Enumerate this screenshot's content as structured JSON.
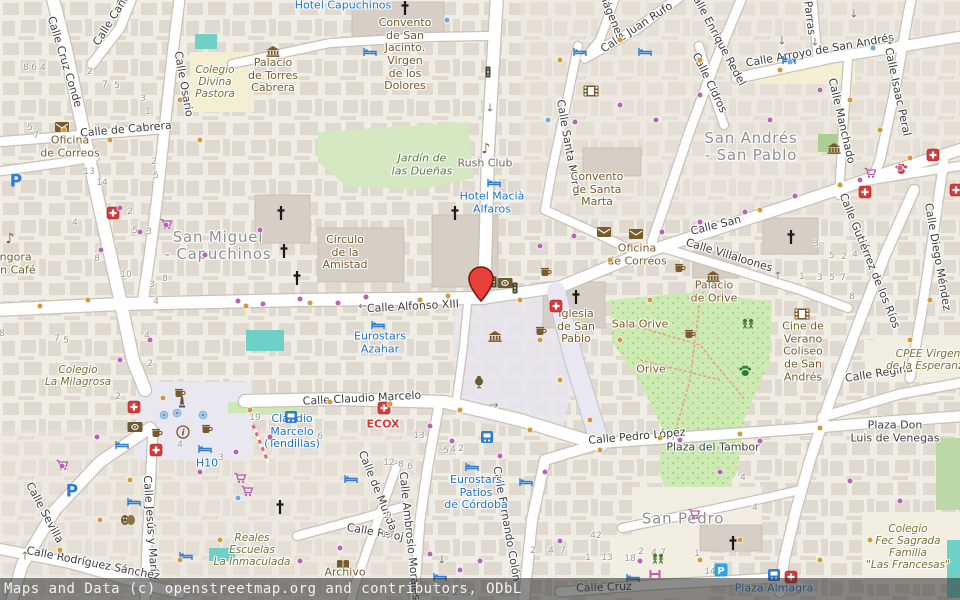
{
  "map": {
    "attribution": "Maps and Data (c) openstreetmap.org and contributors, ODbL",
    "marker": {
      "x": 481,
      "y": 301,
      "fill": "#e8413a",
      "outline": "#7d150f"
    },
    "colors": {
      "land": "#f0ede4",
      "building": "#dcd4cb",
      "road": "#ffffff",
      "casing": "#c8c2b8",
      "pedestrian": "#e9e8f2",
      "park": "#cdeab2",
      "pool": "#6fd0c8",
      "school": "#f4efd2",
      "hotel_blue": "#1f72c9",
      "poi_brown": "#7a5a2b",
      "pharmacy_red": "#d63a3a"
    },
    "district_labels": [
      {
        "t": "San Miguel\n- Capuchinos",
        "x": 218,
        "y": 246
      },
      {
        "t": "San Andrés\n- San Pablo",
        "x": 751,
        "y": 147
      },
      {
        "t": "San Pedro",
        "x": 683,
        "y": 519
      }
    ],
    "street_labels": [
      {
        "t": "Calle Cruz Conde",
        "x": 64,
        "y": 62,
        "r": 73
      },
      {
        "t": "Calle Osario",
        "x": 183,
        "y": 84,
        "r": 80
      },
      {
        "t": "Calle Caño",
        "x": 112,
        "y": 20,
        "r": -58
      },
      {
        "t": "Calle de Cabrera",
        "x": 126,
        "y": 130,
        "r": -5
      },
      {
        "t": "Calle Alfonso XIII",
        "x": 413,
        "y": 307,
        "r": -3
      },
      {
        "t": "Calle San",
        "x": 716,
        "y": 226,
        "r": -14
      },
      {
        "t": "Calle Villaloones",
        "x": 729,
        "y": 256,
        "r": 17
      },
      {
        "t": "Calle Santa Marta",
        "x": 568,
        "y": 148,
        "r": 80
      },
      {
        "t": "Calle Juan Rufo",
        "x": 637,
        "y": 28,
        "r": -33
      },
      {
        "t": "Imágenes",
        "x": 610,
        "y": 14,
        "r": 68
      },
      {
        "t": "Calle Enrique Redel",
        "x": 717,
        "y": 38,
        "r": 62
      },
      {
        "t": "Parras",
        "x": 809,
        "y": 18,
        "r": 83
      },
      {
        "t": "Calle Arroyo de San Andrés",
        "x": 820,
        "y": 51,
        "r": -10
      },
      {
        "t": "Calle Cidros",
        "x": 709,
        "y": 83,
        "r": 64
      },
      {
        "t": "Calle Manchado",
        "x": 841,
        "y": 121,
        "r": 77
      },
      {
        "t": "Calle Isaac Peral",
        "x": 897,
        "y": 92,
        "r": 78
      },
      {
        "t": "Calle Diego Méndez",
        "x": 937,
        "y": 257,
        "r": 80
      },
      {
        "t": "Calle Gutiérrez de los Ríos",
        "x": 869,
        "y": 261,
        "r": 68
      },
      {
        "t": "Calle Regina",
        "x": 879,
        "y": 374,
        "r": -9
      },
      {
        "t": "Calle Claudio Marcelo",
        "x": 362,
        "y": 399,
        "r": -3
      },
      {
        "t": "Calle Pedro López",
        "x": 637,
        "y": 437,
        "r": -5
      },
      {
        "t": "Calle Fernando Colón",
        "x": 506,
        "y": 524,
        "r": 80
      },
      {
        "t": "Calle Ambrosio Morales",
        "x": 409,
        "y": 536,
        "r": 84
      },
      {
        "t": "Calle de Munda",
        "x": 377,
        "y": 491,
        "r": 68
      },
      {
        "t": "Calle Reloj",
        "x": 375,
        "y": 533,
        "r": 10
      },
      {
        "t": "Calle Jesús y María",
        "x": 150,
        "y": 527,
        "r": 86
      },
      {
        "t": "Calle Sevilla",
        "x": 44,
        "y": 513,
        "r": 62
      },
      {
        "t": "Calle Rodríguez Sánchez",
        "x": 93,
        "y": 564,
        "r": 11
      },
      {
        "t": "Calle Cruz",
        "x": 604,
        "y": 588,
        "r": -2
      },
      {
        "t": "Plaza del Tambor",
        "x": 713,
        "y": 448,
        "r": 0,
        "w": 95
      },
      {
        "t": "Plaza Don\nLuis de Venegas",
        "x": 895,
        "y": 432,
        "r": 0
      }
    ],
    "place_labels": [
      {
        "t": "Oficina\nde Correos",
        "x": 70,
        "y": 147,
        "c": "poi"
      },
      {
        "t": "Oficina\nde Correos",
        "x": 637,
        "y": 255,
        "c": "poi"
      },
      {
        "t": "Colegio\nDivina\nPastora",
        "x": 215,
        "y": 82,
        "c": "school"
      },
      {
        "t": "Palacio\nde Torres\nCabrera",
        "x": 273,
        "y": 76,
        "c": "poi"
      },
      {
        "t": "Hotel Capuchinos",
        "x": 343,
        "y": 6,
        "c": "hotel"
      },
      {
        "t": "Convento\nde San\nJacinto.\nVirgen\nde los\nDolores",
        "x": 405,
        "y": 55,
        "c": "poi"
      },
      {
        "t": "Jardín de\nlas Dueñas",
        "x": 422,
        "y": 165,
        "c": "park"
      },
      {
        "t": "Rush Club",
        "x": 485,
        "y": 164,
        "c": "club"
      },
      {
        "t": "Hotel Macià\nAlfaros",
        "x": 492,
        "y": 203,
        "c": "hotel"
      },
      {
        "t": "Convento\nde Santa\nMarta",
        "x": 597,
        "y": 190,
        "c": "poi"
      },
      {
        "t": "Círculo\nde la\nAmistad",
        "x": 345,
        "y": 253,
        "c": "poi"
      },
      {
        "t": "Eurostars\nAzahar",
        "x": 380,
        "y": 343,
        "c": "hotel"
      },
      {
        "t": "Iglesia\nde San\nPablo",
        "x": 576,
        "y": 327,
        "c": "poi"
      },
      {
        "t": "Sala Orive",
        "x": 640,
        "y": 325,
        "c": "poi"
      },
      {
        "t": "Orive",
        "x": 651,
        "y": 370,
        "c": "poi"
      },
      {
        "t": "Palacio\nde Orive",
        "x": 714,
        "y": 292,
        "c": "poi"
      },
      {
        "t": "Cine de\nVerano\nColiseo\nde San\nAndrés",
        "x": 803,
        "y": 352,
        "c": "poi"
      },
      {
        "t": "CPEE Virgen\nde la Esperanza",
        "x": 928,
        "y": 360,
        "c": "school"
      },
      {
        "t": "Colegio\nLa Milagrosa",
        "x": 78,
        "y": 376,
        "c": "school"
      },
      {
        "t": "Góngora\nGran Café",
        "x": 8,
        "y": 264,
        "c": "poi"
      },
      {
        "t": "ECOX",
        "x": 383,
        "y": 425,
        "c": "clinic"
      },
      {
        "t": "Eurostars\nPatios\nde Córdoba",
        "x": 476,
        "y": 493,
        "c": "hotel"
      },
      {
        "t": "H10",
        "x": 207,
        "y": 464,
        "c": "hotel"
      },
      {
        "t": "Claudio\nMarcelo\n(Tendillas)",
        "x": 292,
        "y": 432,
        "c": "transit"
      },
      {
        "t": "Reales\nEscuelas\nLa Inmaculada",
        "x": 252,
        "y": 550,
        "c": "school"
      },
      {
        "t": "Colegio\nFec Sagrada\nFamilia\n\"Las Francesas\"",
        "x": 908,
        "y": 547,
        "c": "school"
      },
      {
        "t": "Archivo",
        "x": 345,
        "y": 573,
        "c": "poi"
      },
      {
        "t": "Plaza Almagra",
        "x": 774,
        "y": 589,
        "c": "transit"
      }
    ],
    "house_numbers": [
      [
        26,
        68,
        "8"
      ],
      [
        34,
        68,
        "6"
      ],
      [
        43,
        68,
        "4"
      ],
      [
        90,
        72,
        "2"
      ],
      [
        105,
        85,
        "7"
      ],
      [
        117,
        86,
        "5"
      ],
      [
        143,
        99,
        "3"
      ],
      [
        148,
        112,
        "1"
      ],
      [
        154,
        162,
        "2"
      ],
      [
        156,
        176,
        "5"
      ],
      [
        89,
        172,
        "13"
      ],
      [
        102,
        183,
        "14"
      ],
      [
        30,
        128,
        "5"
      ],
      [
        36,
        136,
        "7"
      ],
      [
        75,
        223,
        "4"
      ],
      [
        130,
        212,
        "2"
      ],
      [
        135,
        231,
        "5"
      ],
      [
        149,
        232,
        "3"
      ],
      [
        97,
        259,
        "8"
      ],
      [
        126,
        275,
        "10"
      ],
      [
        152,
        285,
        "3"
      ],
      [
        165,
        279,
        "8"
      ],
      [
        156,
        302,
        "4"
      ],
      [
        147,
        336,
        "4"
      ],
      [
        57,
        339,
        "7"
      ],
      [
        66,
        341,
        "5"
      ],
      [
        2,
        334,
        "8"
      ],
      [
        150,
        364,
        "2"
      ],
      [
        118,
        397,
        "2"
      ],
      [
        255,
        418,
        "19"
      ],
      [
        180,
        445,
        "4"
      ],
      [
        221,
        458,
        "3"
      ],
      [
        389,
        463,
        "12"
      ],
      [
        401,
        465,
        "8"
      ],
      [
        410,
        467,
        "6"
      ],
      [
        320,
        437,
        "6"
      ],
      [
        419,
        436,
        "13"
      ],
      [
        389,
        516,
        "9"
      ],
      [
        387,
        535,
        "13"
      ],
      [
        446,
        451,
        "5"
      ],
      [
        453,
        450,
        "4"
      ],
      [
        461,
        449,
        "2"
      ],
      [
        596,
        536,
        "42"
      ],
      [
        533,
        551,
        "2"
      ],
      [
        551,
        551,
        "4"
      ],
      [
        563,
        551,
        "7"
      ],
      [
        588,
        558,
        "1"
      ],
      [
        607,
        558,
        "13"
      ],
      [
        630,
        559,
        "18"
      ],
      [
        444,
        592,
        "36"
      ],
      [
        456,
        593,
        "2"
      ],
      [
        470,
        593,
        "5"
      ],
      [
        816,
        244,
        "3"
      ],
      [
        832,
        256,
        "5"
      ],
      [
        844,
        257,
        "2"
      ],
      [
        855,
        255,
        "4"
      ],
      [
        802,
        277,
        "1"
      ],
      [
        820,
        278,
        "3"
      ],
      [
        832,
        278,
        "5"
      ],
      [
        843,
        278,
        "7"
      ],
      [
        852,
        297,
        "8"
      ],
      [
        743,
        478,
        "4"
      ],
      [
        755,
        508,
        "4"
      ],
      [
        710,
        572,
        "14"
      ],
      [
        697,
        554,
        "1"
      ],
      [
        654,
        553,
        "4"
      ],
      [
        641,
        552,
        "2"
      ],
      [
        663,
        553,
        "7"
      ]
    ],
    "icons": [
      {
        "n": "pharmacy",
        "x": 113,
        "y": 213
      },
      {
        "n": "pharmacy",
        "x": 134,
        "y": 407
      },
      {
        "n": "pharmacy",
        "x": 156,
        "y": 450
      },
      {
        "n": "pharmacy",
        "x": 384,
        "y": 408
      },
      {
        "n": "pharmacy",
        "x": 556,
        "y": 306
      },
      {
        "n": "pharmacy",
        "x": 933,
        "y": 155
      },
      {
        "n": "pharmacy",
        "x": 865,
        "y": 192
      },
      {
        "n": "pharmacy",
        "x": 791,
        "y": 577
      },
      {
        "n": "pharmacy",
        "x": 956,
        "y": 190
      },
      {
        "n": "mail",
        "x": 62,
        "y": 127
      },
      {
        "n": "mail",
        "x": 604,
        "y": 232
      },
      {
        "n": "mail",
        "x": 636,
        "y": 234
      },
      {
        "n": "music",
        "x": 10,
        "y": 239
      },
      {
        "n": "music",
        "x": 486,
        "y": 149
      },
      {
        "n": "church-cross",
        "x": 405,
        "y": 8
      },
      {
        "n": "church-cross",
        "x": 281,
        "y": 213
      },
      {
        "n": "church-cross",
        "x": 284,
        "y": 251
      },
      {
        "n": "church-cross",
        "x": 297,
        "y": 278
      },
      {
        "n": "church-cross",
        "x": 576,
        "y": 297
      },
      {
        "n": "church-cross",
        "x": 791,
        "y": 237
      },
      {
        "n": "church-cross",
        "x": 733,
        "y": 543
      },
      {
        "n": "church-cross",
        "x": 280,
        "y": 507
      },
      {
        "n": "church-cross",
        "x": 455,
        "y": 213
      },
      {
        "n": "hotel-bed",
        "x": 370,
        "y": 52
      },
      {
        "n": "hotel-bed",
        "x": 580,
        "y": 52
      },
      {
        "n": "hotel-bed",
        "x": 645,
        "y": 52
      },
      {
        "n": "hotel-bed",
        "x": 789,
        "y": 60
      },
      {
        "n": "hotel-bed",
        "x": 494,
        "y": 183
      },
      {
        "n": "hotel-bed",
        "x": 378,
        "y": 325
      },
      {
        "n": "hotel-bed",
        "x": 205,
        "y": 449
      },
      {
        "n": "hotel-bed",
        "x": 472,
        "y": 467
      },
      {
        "n": "hotel-bed",
        "x": 526,
        "y": 482
      },
      {
        "n": "hotel-bed",
        "x": 351,
        "y": 479
      },
      {
        "n": "hotel-bed",
        "x": 122,
        "y": 445
      },
      {
        "n": "hotel-bed",
        "x": 134,
        "y": 502
      },
      {
        "n": "hotel-bed",
        "x": 186,
        "y": 556
      },
      {
        "n": "hotel-bed",
        "x": 440,
        "y": 577
      },
      {
        "n": "hotel-bed",
        "x": 633,
        "y": 578
      },
      {
        "n": "bus-stop",
        "x": 487,
        "y": 437
      },
      {
        "n": "bus-stop",
        "x": 291,
        "y": 417
      },
      {
        "n": "bus-stop",
        "x": 774,
        "y": 575
      },
      {
        "n": "parking",
        "x": 16,
        "y": 182
      },
      {
        "n": "parking",
        "x": 72,
        "y": 492
      },
      {
        "n": "parking-box",
        "x": 721,
        "y": 570
      },
      {
        "n": "info",
        "x": 183,
        "y": 432
      },
      {
        "n": "cafe-cup",
        "x": 180,
        "y": 393
      },
      {
        "n": "cafe-cup",
        "x": 157,
        "y": 433
      },
      {
        "n": "cafe-cup",
        "x": 207,
        "y": 429
      },
      {
        "n": "cafe-cup",
        "x": 546,
        "y": 272
      },
      {
        "n": "cafe-cup",
        "x": 541,
        "y": 331
      },
      {
        "n": "cafe-cup",
        "x": 680,
        "y": 268
      },
      {
        "n": "cafe-cup",
        "x": 690,
        "y": 334
      },
      {
        "n": "money",
        "x": 135,
        "y": 427
      },
      {
        "n": "money",
        "x": 505,
        "y": 283
      },
      {
        "n": "cinema-film",
        "x": 591,
        "y": 91
      },
      {
        "n": "cinema-film",
        "x": 802,
        "y": 314
      },
      {
        "n": "shop-cart",
        "x": 166,
        "y": 224
      },
      {
        "n": "shop-cart",
        "x": 62,
        "y": 465
      },
      {
        "n": "shop-cart",
        "x": 240,
        "y": 478
      },
      {
        "n": "shop-cart",
        "x": 247,
        "y": 491
      },
      {
        "n": "shop-cart",
        "x": 870,
        "y": 173
      },
      {
        "n": "shop-cart",
        "x": 694,
        "y": 514
      },
      {
        "n": "theatre-masks",
        "x": 128,
        "y": 520
      },
      {
        "n": "archive-book",
        "x": 343,
        "y": 564
      },
      {
        "n": "amphora",
        "x": 479,
        "y": 381
      },
      {
        "n": "palace-columns",
        "x": 273,
        "y": 51
      },
      {
        "n": "palace-columns",
        "x": 495,
        "y": 336
      },
      {
        "n": "palace-columns",
        "x": 713,
        "y": 276
      },
      {
        "n": "palace-columns",
        "x": 834,
        "y": 148
      },
      {
        "n": "traffic-light",
        "x": 488,
        "y": 72
      },
      {
        "n": "traffic-light",
        "x": 494,
        "y": 282
      },
      {
        "n": "traffic-light",
        "x": 515,
        "y": 288
      },
      {
        "n": "paw-green",
        "x": 745,
        "y": 371
      },
      {
        "n": "paw-red",
        "x": 901,
        "y": 169
      },
      {
        "n": "playground",
        "x": 748,
        "y": 324
      },
      {
        "n": "playground",
        "x": 658,
        "y": 559
      },
      {
        "n": "table-tennis",
        "x": 655,
        "y": 574
      },
      {
        "n": "monument",
        "x": 182,
        "y": 402
      },
      {
        "n": "fountain",
        "x": 164,
        "y": 415
      },
      {
        "n": "fountain",
        "x": 177,
        "y": 413
      },
      {
        "n": "fountain",
        "x": 203,
        "y": 415
      }
    ],
    "oneway_arrows": [
      [
        363,
        306,
        "←"
      ],
      [
        490,
        108,
        "↓"
      ],
      [
        494,
        405,
        "→"
      ],
      [
        782,
        41,
        "↓"
      ],
      [
        815,
        42,
        "↓"
      ],
      [
        854,
        14,
        "↓"
      ],
      [
        890,
        41,
        "↓"
      ],
      [
        778,
        276,
        "↑"
      ],
      [
        442,
        560,
        "↓"
      ],
      [
        25,
        556,
        "↑"
      ]
    ]
  }
}
